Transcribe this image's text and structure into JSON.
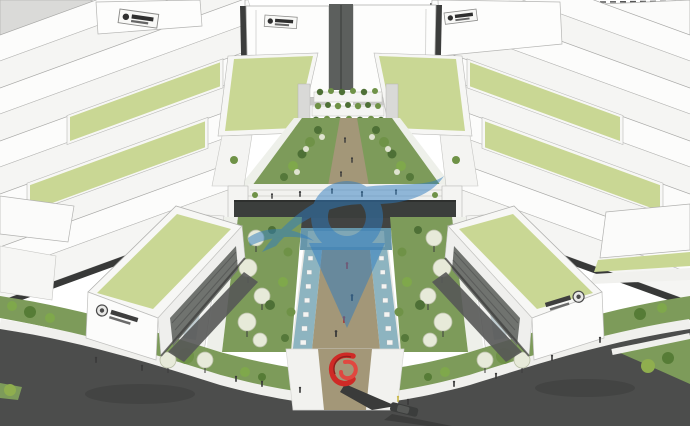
{
  "scene": {
    "kind": "3d-architectural-rendering",
    "subject": "business-park-masterplan-with-central-landscape-axis",
    "view": "aerial-perspective"
  },
  "colors": {
    "background": "#ffffff",
    "building_white": "#fcfcfb",
    "building_front": "#f5f5f3",
    "building_edge": "#a8a8a6",
    "context_gray": "#dadad8",
    "roof_green": "#c9d794",
    "roof_border": "#f7f7f5",
    "lawn_green": "#7d9b5a",
    "lawn_dark": "#5d7d46",
    "tree_dark_green": "#4e7036",
    "tree_mid_green": "#6f9247",
    "shrub_light_green": "#8fae4e",
    "tree_pale": "#e7ead9",
    "water_channel_blue": "#8db4c0",
    "pool_blue": "#6796aa",
    "path_tan": "#a39778",
    "plaza_white": "#f2f2ef",
    "bridge_dark": "#3b3e3c",
    "louver_gray": "#70736f",
    "road_asphalt": "#4c4d4c",
    "shadow_dark": "#3a3b3a",
    "sculpture_red": "#cf2a26",
    "watermark_blue": "#2e7cc0",
    "figure_dark": "#3a3a3a",
    "sign_dark": "#2f2f2f"
  },
  "watermark": {
    "opacity": 0.5
  },
  "signs": {
    "plaque_count": 5,
    "emblem_count": 2,
    "text_legible": false
  },
  "landmarks": [
    "central-landscape-axis",
    "twin-water-channels-with-stepping-stones",
    "elevated-dark-bridge",
    "terraced-green-building",
    "red-spiral-sculpture",
    "green-roof-slabs",
    "perimeter-road"
  ]
}
